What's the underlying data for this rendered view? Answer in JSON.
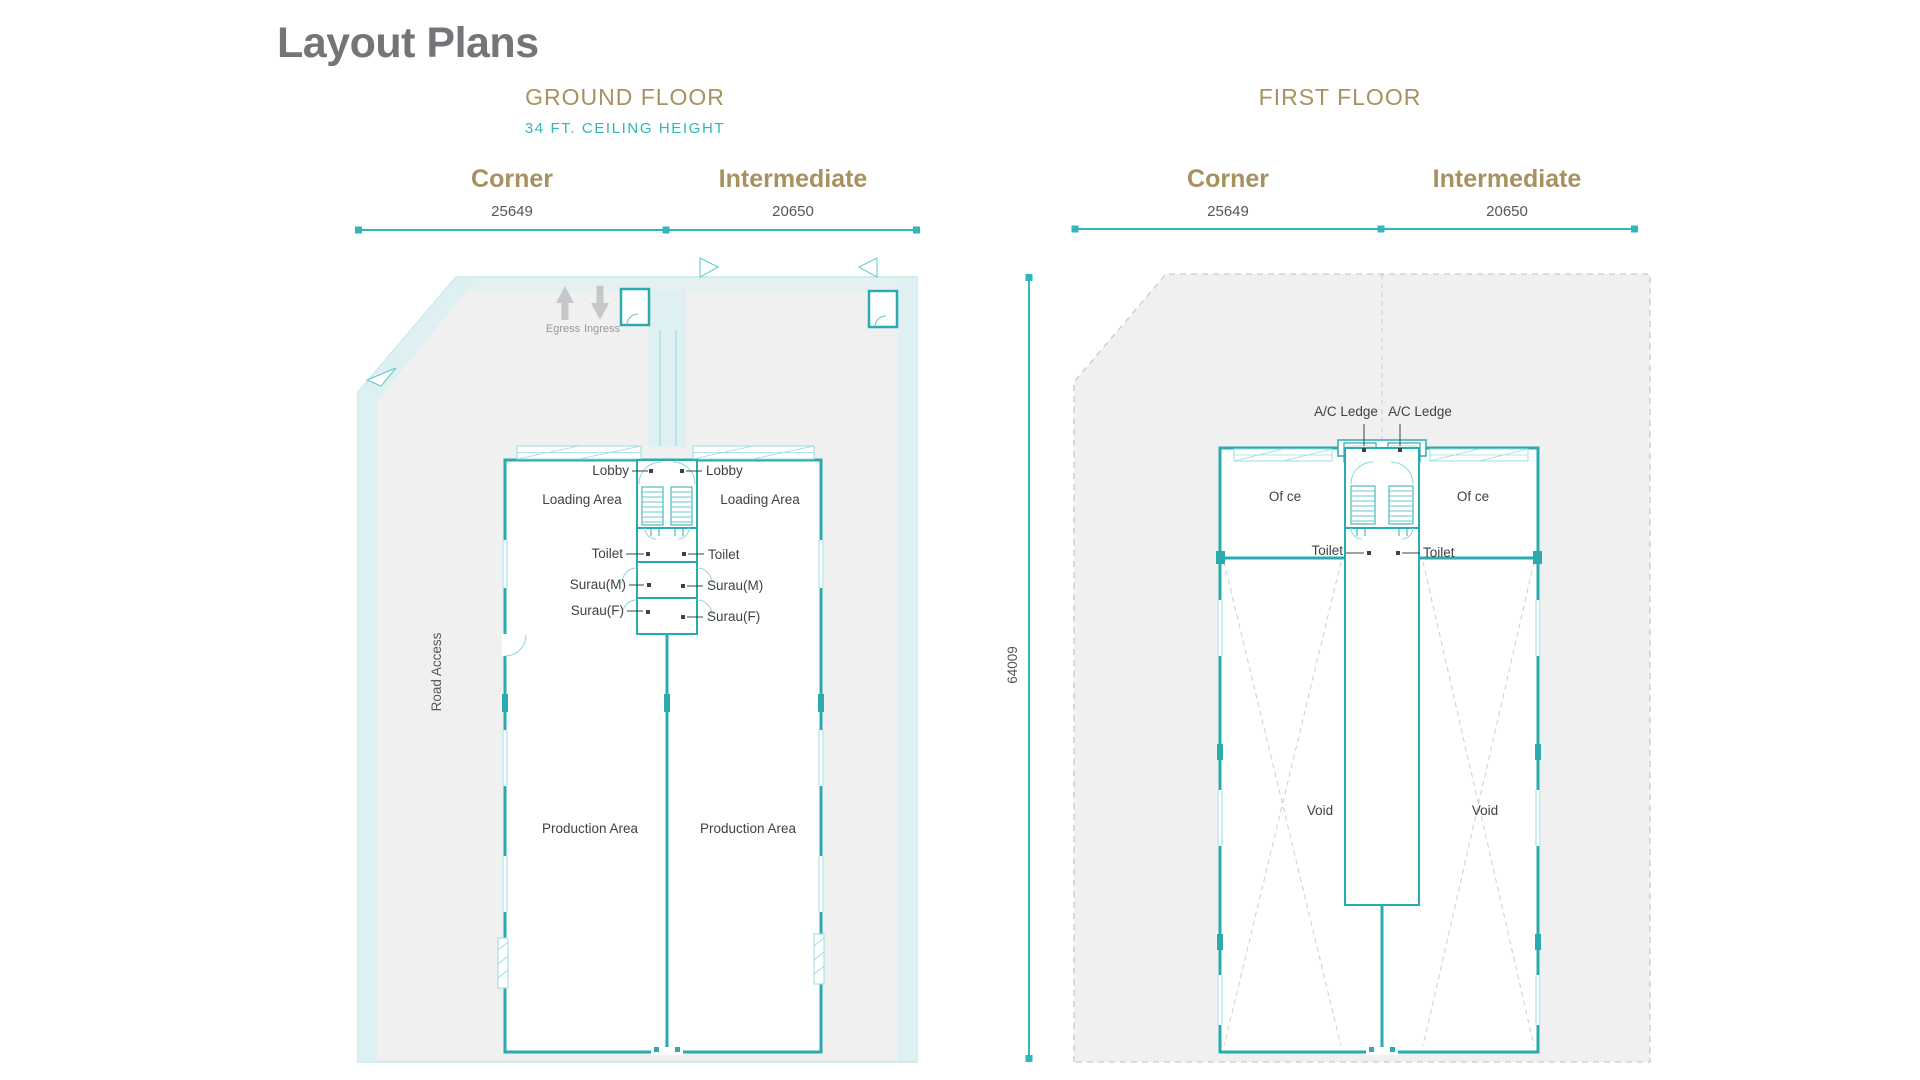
{
  "title": "Layout Plans",
  "ground_floor": {
    "heading": "GROUND FLOOR",
    "ceiling_note": "34 FT. CEILING HEIGHT",
    "corner": {
      "label": "Corner",
      "width": "25649"
    },
    "intermediate": {
      "label": "Intermediate",
      "width": "20650"
    },
    "rooms": {
      "lobby": "Lobby",
      "loading_area": "Loading Area",
      "toilet": "Toilet",
      "surau_m": "Surau(M)",
      "surau_f": "Surau(F)",
      "production_area": "Production Area"
    },
    "site": {
      "egress": "Egress",
      "ingress": "Ingress",
      "road_access": "Road Access"
    }
  },
  "first_floor": {
    "heading": "FIRST FLOOR",
    "corner": {
      "label": "Corner",
      "width": "25649"
    },
    "intermediate": {
      "label": "Intermediate",
      "width": "20650"
    },
    "overall_depth": "64009",
    "rooms": {
      "ac_ledge": "A/C Ledge",
      "office": "Of ce",
      "toilet": "Toilet",
      "void": "Void"
    }
  },
  "colors": {
    "accent_teal": "#2fb7ba",
    "wall_teal": "#2aabaf",
    "light_teal": "#9adde0",
    "heading_gold": "#a7925f",
    "title_gray": "#737578",
    "parcel_gray": "#f0f0f1",
    "label_dark": "#3f4145"
  }
}
